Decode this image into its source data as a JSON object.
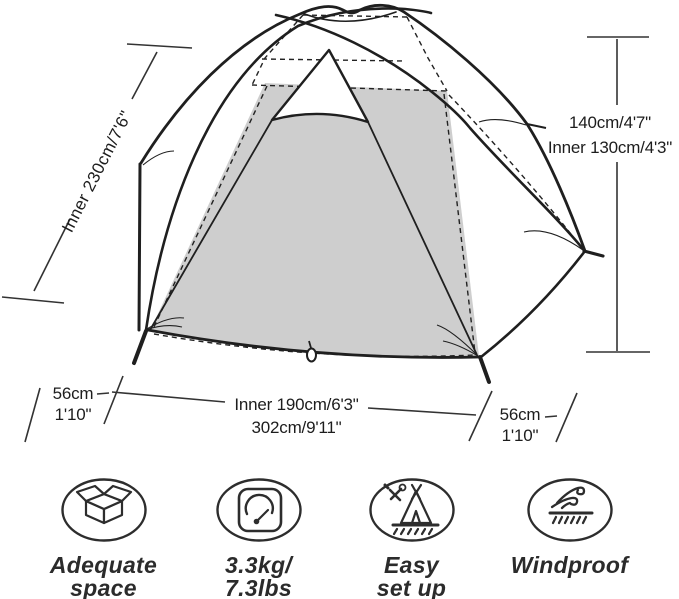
{
  "colors": {
    "line": "#1f1f1f",
    "panel_gray": "#cecece",
    "text": "#1d1d1d",
    "background": "#ffffff"
  },
  "tent_diagram": {
    "dimensions": {
      "side_length": "Inner 230cm/7'6\"",
      "height_line1": "140cm/4'7\"",
      "height_line2": "Inner 130cm/4'3\"",
      "left_vestibule_line1": "56cm",
      "left_vestibule_line2": "1'10\"",
      "width_line1": "Inner 190cm/6'3\"",
      "width_line2": "302cm/9'11\"",
      "right_vestibule_line1": "56cm",
      "right_vestibule_line2": "1'10\""
    }
  },
  "features": [
    {
      "icon": "open-box-icon",
      "lines": [
        "Adequate",
        "space"
      ]
    },
    {
      "icon": "scale-icon",
      "lines": [
        "3.3kg/",
        "7.3lbs"
      ]
    },
    {
      "icon": "tent-setup-icon",
      "lines": [
        "Easy",
        "set up"
      ]
    },
    {
      "icon": "wind-icon",
      "lines": [
        "Windproof"
      ]
    }
  ]
}
